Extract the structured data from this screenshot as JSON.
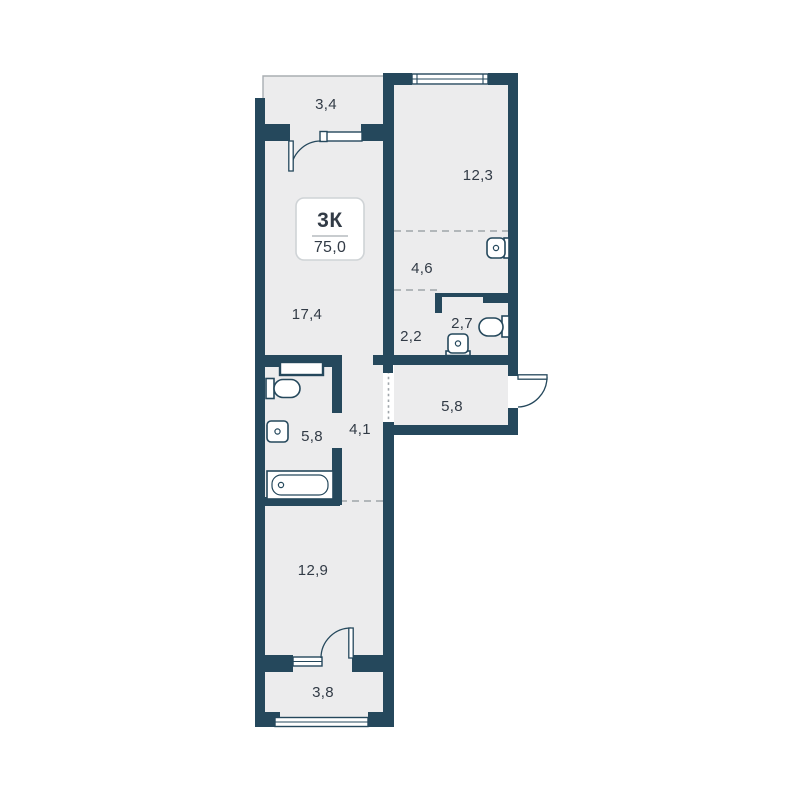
{
  "plan": {
    "badge": {
      "type_label": "3К",
      "total_area": "75,0"
    },
    "rooms": [
      {
        "id": "balcony-top",
        "area": "3,4"
      },
      {
        "id": "bedroom",
        "area": "12,3"
      },
      {
        "id": "corridor",
        "area": "4,6"
      },
      {
        "id": "wc-lobby",
        "area": "2,2"
      },
      {
        "id": "wc",
        "area": "2,7"
      },
      {
        "id": "living-room",
        "area": "17,4"
      },
      {
        "id": "bathroom",
        "area": "5,8"
      },
      {
        "id": "hallway",
        "area": "4,1"
      },
      {
        "id": "entry-hall",
        "area": "5,8"
      },
      {
        "id": "bedroom-2",
        "area": "12,9"
      },
      {
        "id": "balcony-bottom",
        "area": "3,8"
      }
    ],
    "fixtures": [
      "toilet",
      "sink",
      "bathtub",
      "toilet",
      "sink",
      "sink"
    ],
    "colors": {
      "wall": "#25485C",
      "floor": "#ECECED",
      "bg": "#FFFFFF",
      "text": "#323B46",
      "dash": "#9FA5AA",
      "thin": "#A9AEB2",
      "badge_border": "#CFD3D6",
      "divider": "#B6BBBF"
    }
  }
}
